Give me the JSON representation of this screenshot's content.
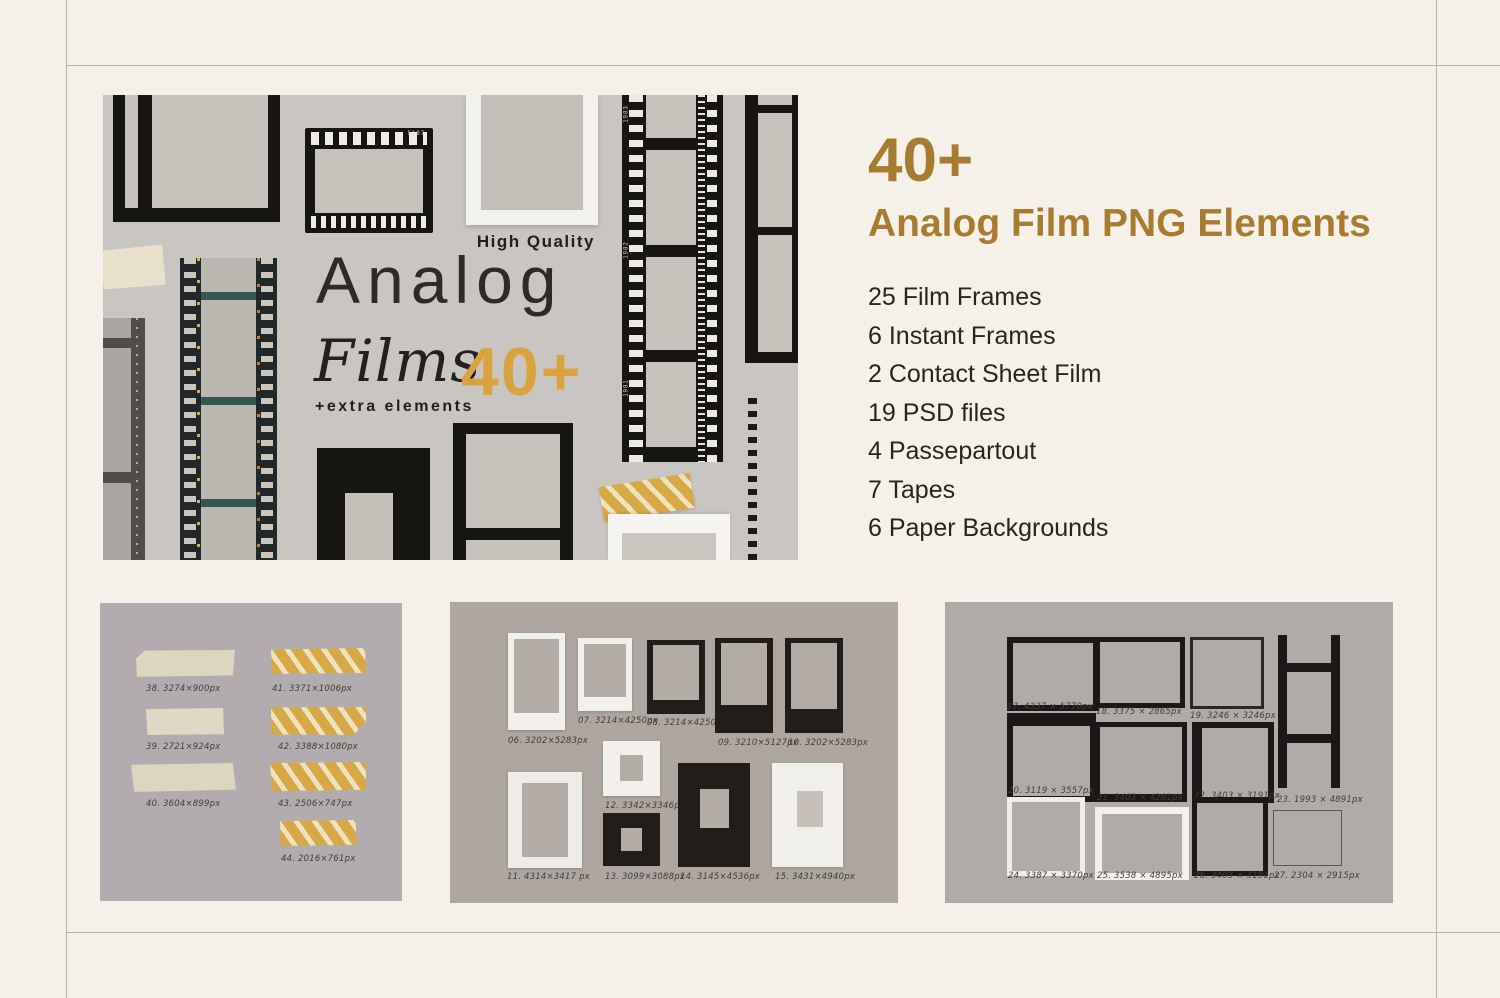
{
  "hero": {
    "high_quality": "High Quality",
    "title": "Analog",
    "title_serif": "Films",
    "badge": "40+",
    "subtitle": "+extra elements",
    "film_code": "5187",
    "strip_years": [
      "1983",
      "1982",
      "1981"
    ]
  },
  "info": {
    "count": "40+",
    "heading": "Analog Film PNG Elements",
    "items": [
      "25 Film Frames",
      "6 Instant Frames",
      "2 Contact Sheet Film",
      "19 PSD files",
      "4 Passepartout",
      "7 Tapes",
      "6 Paper Backgrounds"
    ]
  },
  "panels": {
    "tapes": {
      "labels": [
        "38. 3274×900px",
        "39. 2721×924px",
        "40. 3604×899px",
        "41. 3371×1006px",
        "42. 3388×1080px",
        "43. 2506×747px",
        "44. 2016×761px"
      ]
    },
    "instant": {
      "labels": [
        "06. 3202×5283px",
        "07. 3214×4250px",
        "08. 3214×4250px",
        "09. 3210×5127px",
        "10. 3202×5283px",
        "11. 4314×3417 px",
        "12. 3342×3346px",
        "13. 3099×3088px",
        "14. 3145×4536px",
        "15. 3431×4940px"
      ]
    },
    "frames": {
      "labels": [
        "17. 4337 × 5770px",
        "18. 3375 × 2865px",
        "19. 3246 × 3246px",
        "20. 3119 × 3557px",
        "21. 3403 × 4281px",
        "22. 3403 × 3191px",
        "23. 1993 × 4891px",
        "24. 3387 × 3370px",
        "25. 3538 × 4895px",
        "26. 3403 × 3191px",
        "27. 2304 × 2915px"
      ]
    }
  },
  "colors": {
    "page_bg": "#f6f1e8",
    "hero_bg": "#c9c5c0",
    "accent_gold": "#a87c30",
    "badge_gold": "#d9a440",
    "ink": "#26251f",
    "rule": "#b8b3aa"
  }
}
